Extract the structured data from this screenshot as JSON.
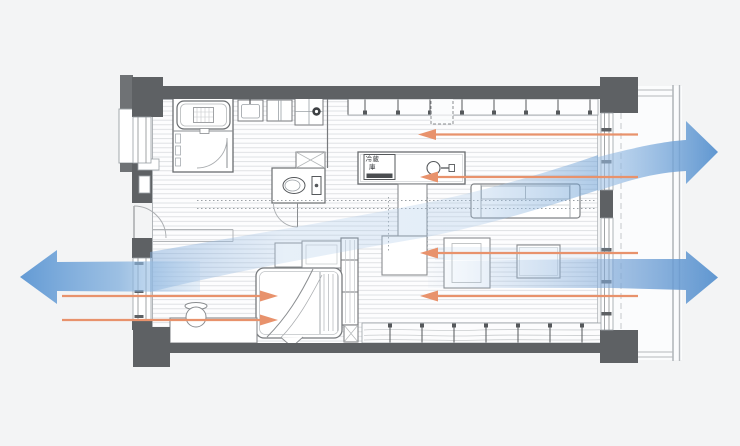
{
  "diagram": {
    "type": "floor-plan-airflow",
    "labels": {
      "refrigerator": "冷蔵庫"
    },
    "palette": {
      "background": "#f3f4f5",
      "wall": "#5e6164",
      "floor_hatch_line": "#b9bdc3",
      "breeze_orange": "#e8926c",
      "airflow_blue": "#5c96d3",
      "airflow_blue_light": "#a9c8e8"
    },
    "airflow": {
      "main_flow_arrows": [
        {
          "name": "exit-left-window",
          "direction": "left"
        },
        {
          "name": "exit-upper-right-window",
          "direction": "right"
        },
        {
          "name": "exit-lower-right-window",
          "direction": "right"
        }
      ],
      "breeze_arrows": [
        {
          "name": "breeze-from-right-1",
          "direction": "left"
        },
        {
          "name": "breeze-from-right-2",
          "direction": "left"
        },
        {
          "name": "breeze-from-right-3",
          "direction": "left"
        },
        {
          "name": "breeze-from-right-4",
          "direction": "left"
        },
        {
          "name": "breeze-from-left-1",
          "direction": "right"
        },
        {
          "name": "breeze-from-left-2",
          "direction": "right"
        }
      ]
    }
  }
}
